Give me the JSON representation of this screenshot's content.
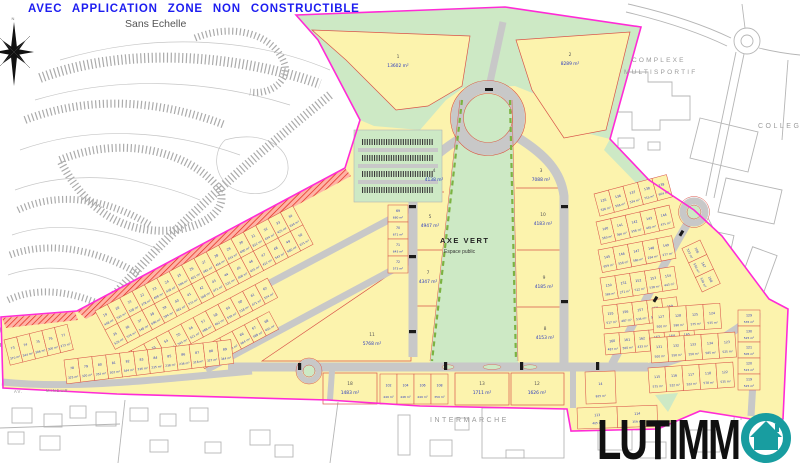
{
  "page": {
    "title": "AVEC APPLICATION ZONE NON CONSTRUCTIBLE",
    "scale_note": "Sans Echelle"
  },
  "compass": {
    "north": "N"
  },
  "logo": {
    "text": "LUTIMM",
    "icon": "house-in-circle",
    "color": "#189da0"
  },
  "colors": {
    "boundary": "#ff2bd6",
    "parcel_fill": "#fcf3ad",
    "parcel_line": "#d9544a",
    "green": "#cde9c5",
    "road": "#c8c8c8",
    "label_blue": "#2b3bbd",
    "title_blue": "#1d1df0",
    "hatch_red": "#e02818"
  },
  "map": {
    "area_labels": {
      "axe_vert_line1": "AXE  VERT",
      "axe_vert_line2": "Espace public",
      "complexe_line1": "COMPLEXE",
      "complexe_line2": "MULTISPORTIF",
      "college": "COLLEGE",
      "intermarche": "INTERMARCHE",
      "street_prefix": "AV.",
      "street_name": "MINEUR"
    },
    "large_parcels": [
      {
        "n": "1",
        "a": "13602 m²",
        "x": 398,
        "y": 58
      },
      {
        "n": "2",
        "a": "8289 m²",
        "x": 570,
        "y": 56
      },
      {
        "n": "4",
        "a": "4138 m²",
        "x": 434,
        "y": 172
      },
      {
        "n": "3",
        "a": "7088 m²",
        "x": 541,
        "y": 172
      },
      {
        "n": "5",
        "a": "4947 m²",
        "x": 430,
        "y": 218
      },
      {
        "n": "10",
        "a": "4183 m²",
        "x": 543,
        "y": 216
      },
      {
        "n": "7",
        "a": "4347 m²",
        "x": 428,
        "y": 274
      },
      {
        "n": "9",
        "a": "4185 m²",
        "x": 544,
        "y": 279
      },
      {
        "n": "11",
        "a": "5768 m²",
        "x": 372,
        "y": 336
      },
      {
        "n": "8",
        "a": "4153 m²",
        "x": 545,
        "y": 330
      },
      {
        "n": "18",
        "a": "1483 m²",
        "x": 350,
        "y": 385
      },
      {
        "n": "13",
        "a": "1711 m²",
        "x": 482,
        "y": 385
      },
      {
        "n": "12",
        "a": "1626 m²",
        "x": 537,
        "y": 385
      }
    ],
    "clusters": [
      {
        "name": "left-block",
        "rows": [
          {
            "x": 95,
            "y": 311,
            "angle": -28,
            "cw": 14,
            "ch": 22,
            "parcels": [
              [
                "19",
                "448 m²"
              ],
              [
                "20",
                "522 m²"
              ],
              [
                "21",
                "538 m²"
              ],
              [
                "22",
                "378 m²"
              ],
              [
                "23",
                "408 m²"
              ],
              [
                "24",
                "438 m²"
              ],
              [
                "25",
                "506 m²"
              ],
              [
                "26",
                "401 m²"
              ],
              [
                "27",
                "481 m²"
              ],
              [
                "28",
                "456 m²"
              ],
              [
                "29",
                "432 m²"
              ],
              [
                "30",
                "690 m²"
              ],
              [
                "31",
                "812 m²"
              ],
              [
                "32",
                "424 m²"
              ],
              [
                "33",
                "425 m²"
              ],
              [
                "34",
                "624 m²"
              ]
            ]
          },
          {
            "x": 105,
            "y": 330,
            "angle": -28,
            "cw": 14,
            "ch": 22,
            "parcels": [
              [
                "35",
                "526 m²"
              ],
              [
                "36",
                "574 m²"
              ],
              [
                "37",
                "548 m²"
              ],
              [
                "38",
                "690 m²"
              ],
              [
                "39",
                "594 m²"
              ],
              [
                "40",
                "482 m²"
              ],
              [
                "41",
                "571 m²"
              ],
              [
                "42",
                "568 m²"
              ],
              [
                "43",
                "471 m²"
              ],
              [
                "44",
                "521 m²"
              ],
              [
                "45",
                "406 m²"
              ],
              [
                "46",
                "425 m²"
              ],
              [
                "47",
                "412 m²"
              ],
              [
                "48",
                "543 m²"
              ],
              [
                "49",
                "680 m²"
              ],
              [
                "50",
                "671 m²"
              ]
            ]
          },
          {
            "x": 119,
            "y": 357,
            "angle": -28,
            "cw": 14,
            "ch": 22,
            "parcels": [
              [
                "51",
                "643 m²"
              ],
              [
                "52",
                "573 m²"
              ],
              [
                "53",
                "566 m²"
              ],
              [
                "54",
                "676 m²"
              ],
              [
                "55",
                "545 m²"
              ],
              [
                "56",
                "521 m²"
              ],
              [
                "57",
                "488 m²"
              ],
              [
                "58",
                "462 m²"
              ],
              [
                "59",
                "530 m²"
              ],
              [
                "60",
                "518 m²"
              ],
              [
                "61",
                "471 m²"
              ],
              [
                "62",
                "524 m²"
              ]
            ]
          },
          {
            "x": 195,
            "y": 351,
            "angle": -28,
            "cw": 14,
            "ch": 20,
            "parcels": [
              [
                "63",
                "531 m²"
              ],
              [
                "64",
                "555 m²"
              ],
              [
                "65",
                "583 m²"
              ],
              [
                "66",
                "664 m²"
              ],
              [
                "67",
                "588 m²"
              ],
              [
                "68",
                "655 m²"
              ]
            ]
          },
          {
            "x": 408,
            "y": 205,
            "angle": 90,
            "cw": 17,
            "ch": 20,
            "parcels": [
              [
                "69",
                "680 m²"
              ],
              [
                "70",
                "671 m²"
              ],
              [
                "71",
                "643 m²"
              ],
              [
                "72",
                "573 m²"
              ]
            ]
          }
        ]
      },
      {
        "name": "southwest-strip",
        "rows": [
          {
            "x": 4,
            "y": 340,
            "angle": -14,
            "cw": 13,
            "ch": 26,
            "parcels": [
              [
                "73",
                "370 m²"
              ],
              [
                "74",
                "344 m²"
              ],
              [
                "75",
                "386 m²"
              ],
              [
                "76",
                "300 m²"
              ],
              [
                "77",
                "273 m²"
              ]
            ]
          },
          {
            "x": 64,
            "y": 360,
            "angle": -7,
            "cw": 14,
            "ch": 24,
            "parcels": [
              [
                "78",
                "325 m²"
              ],
              [
                "79",
                "320 m²"
              ],
              [
                "80",
                "352 m²"
              ],
              [
                "81",
                "302 m²"
              ],
              [
                "82",
                "344 m²"
              ],
              [
                "83",
                "236 m²"
              ],
              [
                "84",
                "235 m²"
              ],
              [
                "85",
                "238 m²"
              ],
              [
                "86",
                "236 m²"
              ],
              [
                "87",
                "318 m²"
              ],
              [
                "88",
                "327 m²"
              ],
              [
                "89",
                "344 m²"
              ]
            ]
          }
        ]
      },
      {
        "name": "south-row",
        "rows": [
          {
            "x": 380,
            "y": 374,
            "angle": 0,
            "cw": 17,
            "ch": 30,
            "parcels": [
              [
                "102",
                "449 m²"
              ],
              [
                "104",
                "448 m²"
              ],
              [
                "106",
                "449 m²"
              ],
              [
                "108",
                "359 m²"
              ]
            ]
          },
          {
            "x": 585,
            "y": 372,
            "angle": -2,
            "cw": 30,
            "ch": 32,
            "parcels": [
              [
                "14",
                "825 m²"
              ]
            ]
          },
          {
            "x": 577,
            "y": 408,
            "angle": -2,
            "cw": 40,
            "ch": 21,
            "parcels": [
              [
                "113",
                "405 m²"
              ],
              [
                "114",
                "359 m²"
              ]
            ]
          }
        ]
      },
      {
        "name": "east-block",
        "rows": [
          {
            "x": 594,
            "y": 194,
            "angle": -15,
            "cw": 15,
            "ch": 23,
            "parcels": [
              [
                "135",
                "536 m²"
              ],
              [
                "136",
                "556 m²"
              ],
              [
                "137",
                "534 m²"
              ],
              [
                "138",
                "715 m²"
              ],
              [
                "139",
                "604 m²"
              ]
            ]
          },
          {
            "x": 596,
            "y": 222,
            "angle": -13,
            "cw": 15,
            "ch": 23,
            "parcels": [
              [
                "140",
                "560 m²"
              ],
              [
                "141",
                "360 m²"
              ],
              [
                "142",
                "556 m²"
              ],
              [
                "143",
                "445 m²"
              ],
              [
                "144",
                "471 m²"
              ]
            ]
          },
          {
            "x": 598,
            "y": 250,
            "angle": -11,
            "cw": 15,
            "ch": 23,
            "parcels": [
              [
                "145",
                "659 m²"
              ],
              [
                "146",
                "556 m²"
              ],
              [
                "147",
                "560 m²"
              ],
              [
                "148",
                "294 m²"
              ],
              [
                "149",
                "277 m²"
              ]
            ]
          },
          {
            "x": 600,
            "y": 278,
            "angle": -9,
            "cw": 15,
            "ch": 23,
            "parcels": [
              [
                "150",
                "369 m²"
              ],
              [
                "151",
                "271 m²"
              ],
              [
                "152",
                "512 m²"
              ],
              [
                "153",
                "538 m²"
              ],
              [
                "154",
                "443 m²"
              ]
            ]
          },
          {
            "x": 602,
            "y": 306,
            "angle": -7,
            "cw": 15,
            "ch": 23,
            "parcels": [
              [
                "155",
                "517 m²"
              ],
              [
                "156",
                "487 m²"
              ],
              [
                "157",
                "534 m²"
              ],
              [
                "158",
                "525 m²"
              ],
              [
                "159",
                "418 m²"
              ]
            ]
          },
          {
            "x": 604,
            "y": 334,
            "angle": -5,
            "cw": 15,
            "ch": 21,
            "parcels": [
              [
                "160",
                "487 m²"
              ],
              [
                "161",
                "500 m²"
              ],
              [
                "162",
                "433 m²"
              ],
              [
                "163",
                "459 m²"
              ],
              [
                "164",
                "452 m²"
              ],
              [
                "165",
                "443 m²"
              ]
            ]
          },
          {
            "x": 700,
            "y": 240,
            "angle": 65,
            "cw": 16,
            "ch": 20,
            "parcels": [
              [
                "166",
                "523 m²"
              ],
              [
                "167",
                "556 m²"
              ],
              [
                "168",
                "534 m²"
              ]
            ]
          }
        ]
      },
      {
        "name": "southeast-block",
        "rows": [
          {
            "x": 652,
            "y": 308,
            "angle": -4,
            "cw": 17,
            "ch": 25,
            "parcels": [
              [
                "127",
                "500 m²"
              ],
              [
                "128",
                "590 m²"
              ],
              [
                "125",
                "575 m²"
              ],
              [
                "124",
                "535 m²"
              ]
            ]
          },
          {
            "x": 650,
            "y": 338,
            "angle": -4,
            "cw": 17,
            "ch": 25,
            "parcels": [
              [
                "131",
                "500 m²"
              ],
              [
                "132",
                "550 m²"
              ],
              [
                "133",
                "550 m²"
              ],
              [
                "134",
                "585 m²"
              ],
              [
                "123",
                "525 m²"
              ]
            ]
          },
          {
            "x": 648,
            "y": 368,
            "angle": -4,
            "cw": 17,
            "ch": 25,
            "parcels": [
              [
                "115",
                "575 m²"
              ],
              [
                "116",
                "522 m²"
              ],
              [
                "117",
                "522 m²"
              ],
              [
                "118",
                "578 m²"
              ],
              [
                "122",
                "535 m²"
              ]
            ]
          },
          {
            "x": 760,
            "y": 310,
            "angle": 90,
            "cw": 16,
            "ch": 22,
            "parcels": [
              [
                "129",
                "535 m²"
              ],
              [
                "130",
                "525 m²"
              ],
              [
                "121",
                "505 m²"
              ],
              [
                "120",
                "515 m²"
              ],
              [
                "119",
                "525 m²"
              ]
            ]
          }
        ]
      }
    ]
  }
}
